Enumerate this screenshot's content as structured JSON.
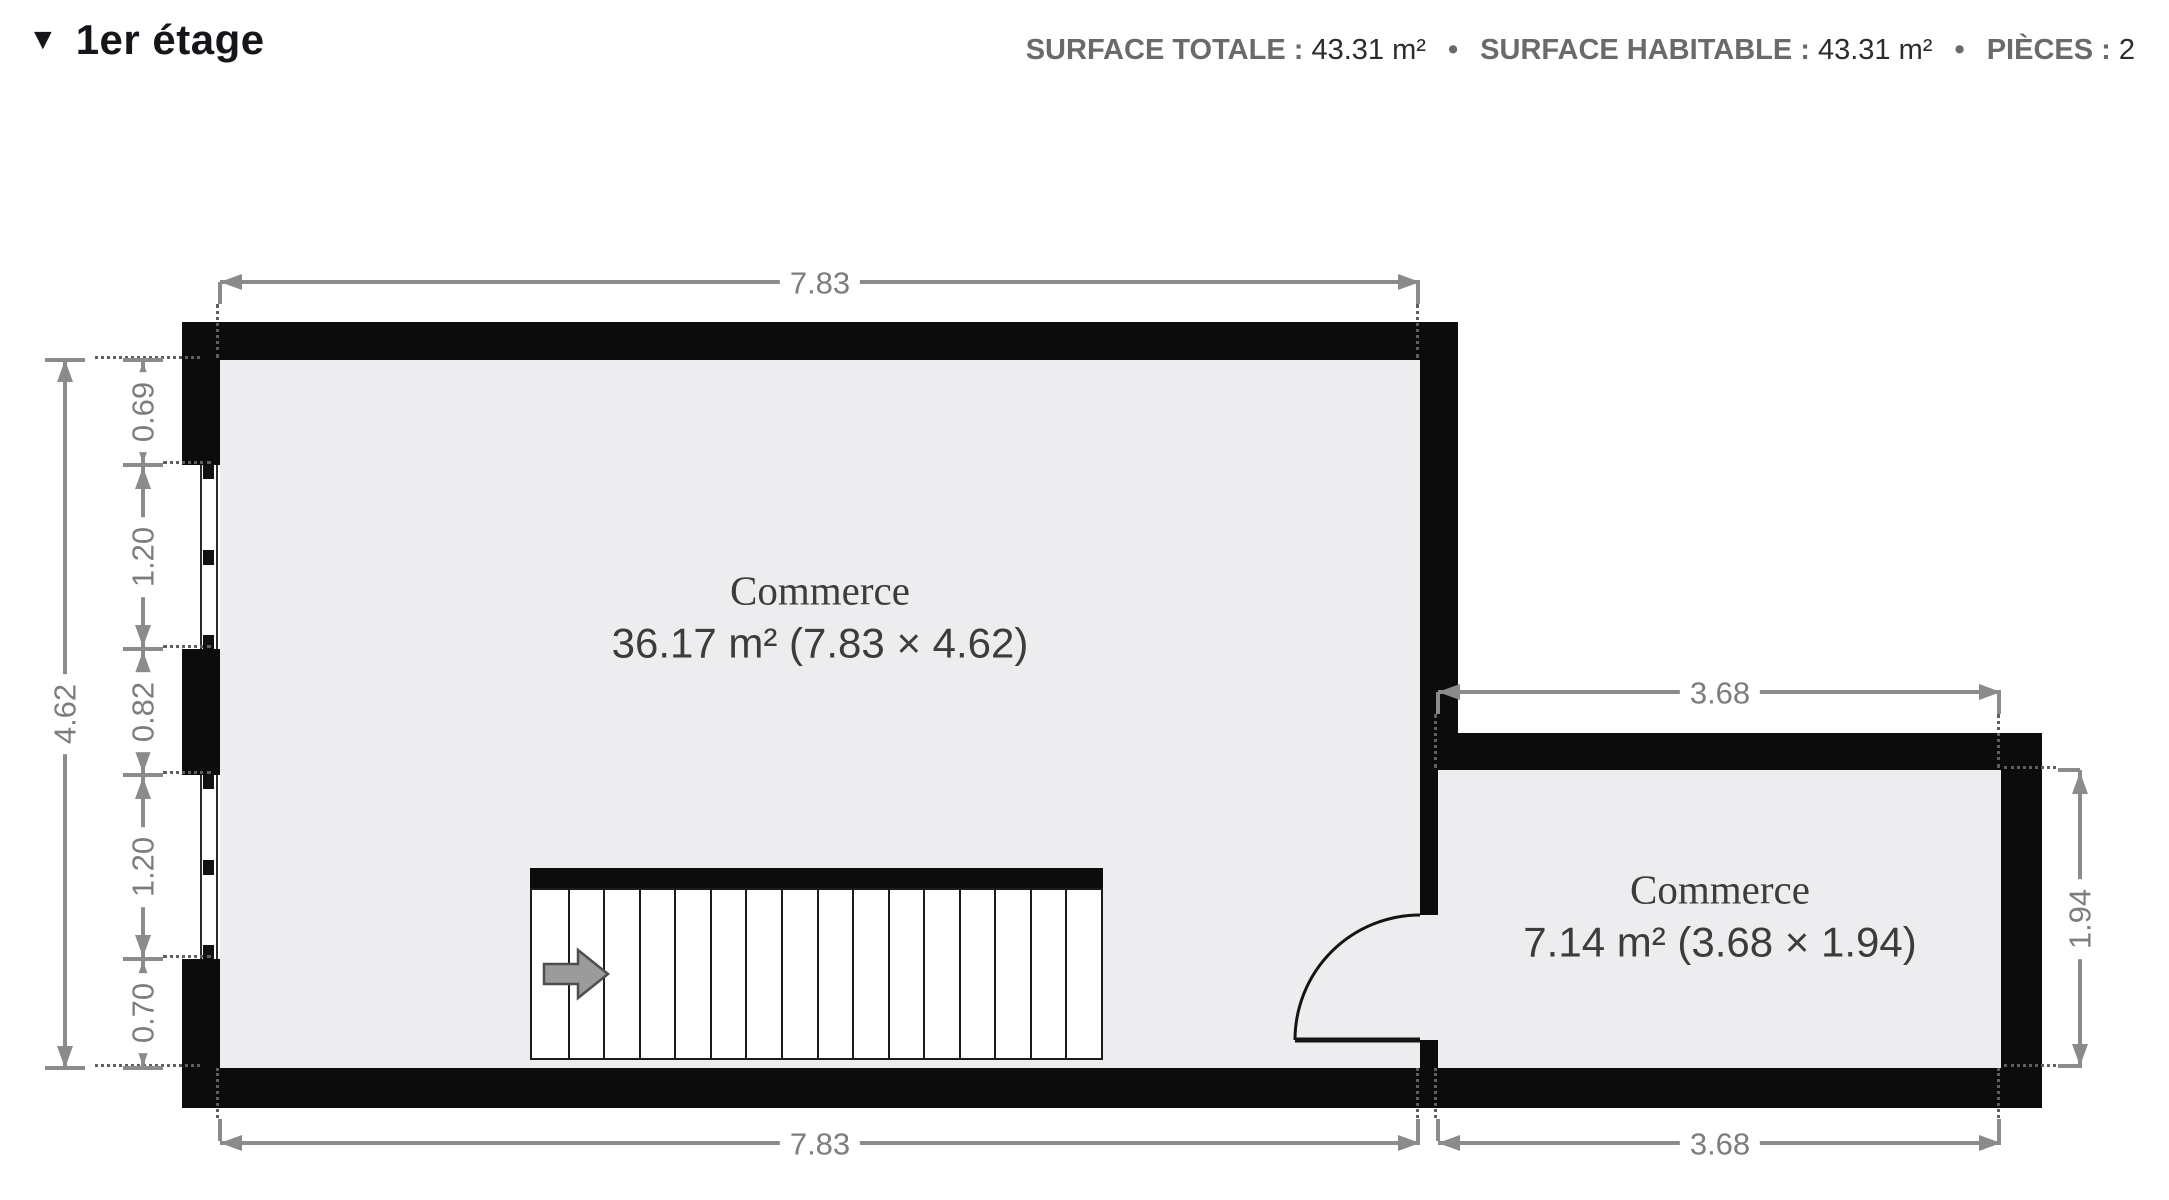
{
  "header": {
    "collapse_icon": "▼",
    "floor_label": "1er étage",
    "separator": "•",
    "stats": [
      {
        "label": "SURFACE TOTALE :",
        "value": "43.31 m²"
      },
      {
        "label": "SURFACE HABITABLE :",
        "value": "43.31 m²"
      },
      {
        "label": "PIÈCES :",
        "value": "2"
      }
    ]
  },
  "rooms": [
    {
      "name": "Commerce",
      "area": "36.17 m² (7.83 × 4.62)"
    },
    {
      "name": "Commerce",
      "area": "7.14 m² (3.68 × 1.94)"
    }
  ],
  "dimensions": {
    "top_width": "7.83",
    "bottom_width": "7.83",
    "left_height": "4.62",
    "left_segments": [
      "0.69",
      "1.20",
      "0.82",
      "1.20",
      "0.70"
    ],
    "small_top_width": "3.68",
    "small_bottom_width": "3.68",
    "small_right_height": "1.94"
  },
  "colors": {
    "wall": "#0c0c0c",
    "floor": "#ededef",
    "dimension": "#8b8b8b",
    "room_text": "#3c3c3c",
    "title_text": "#15151a",
    "stat_label": "#6a6a6a",
    "stat_value": "#2c2c2c"
  }
}
